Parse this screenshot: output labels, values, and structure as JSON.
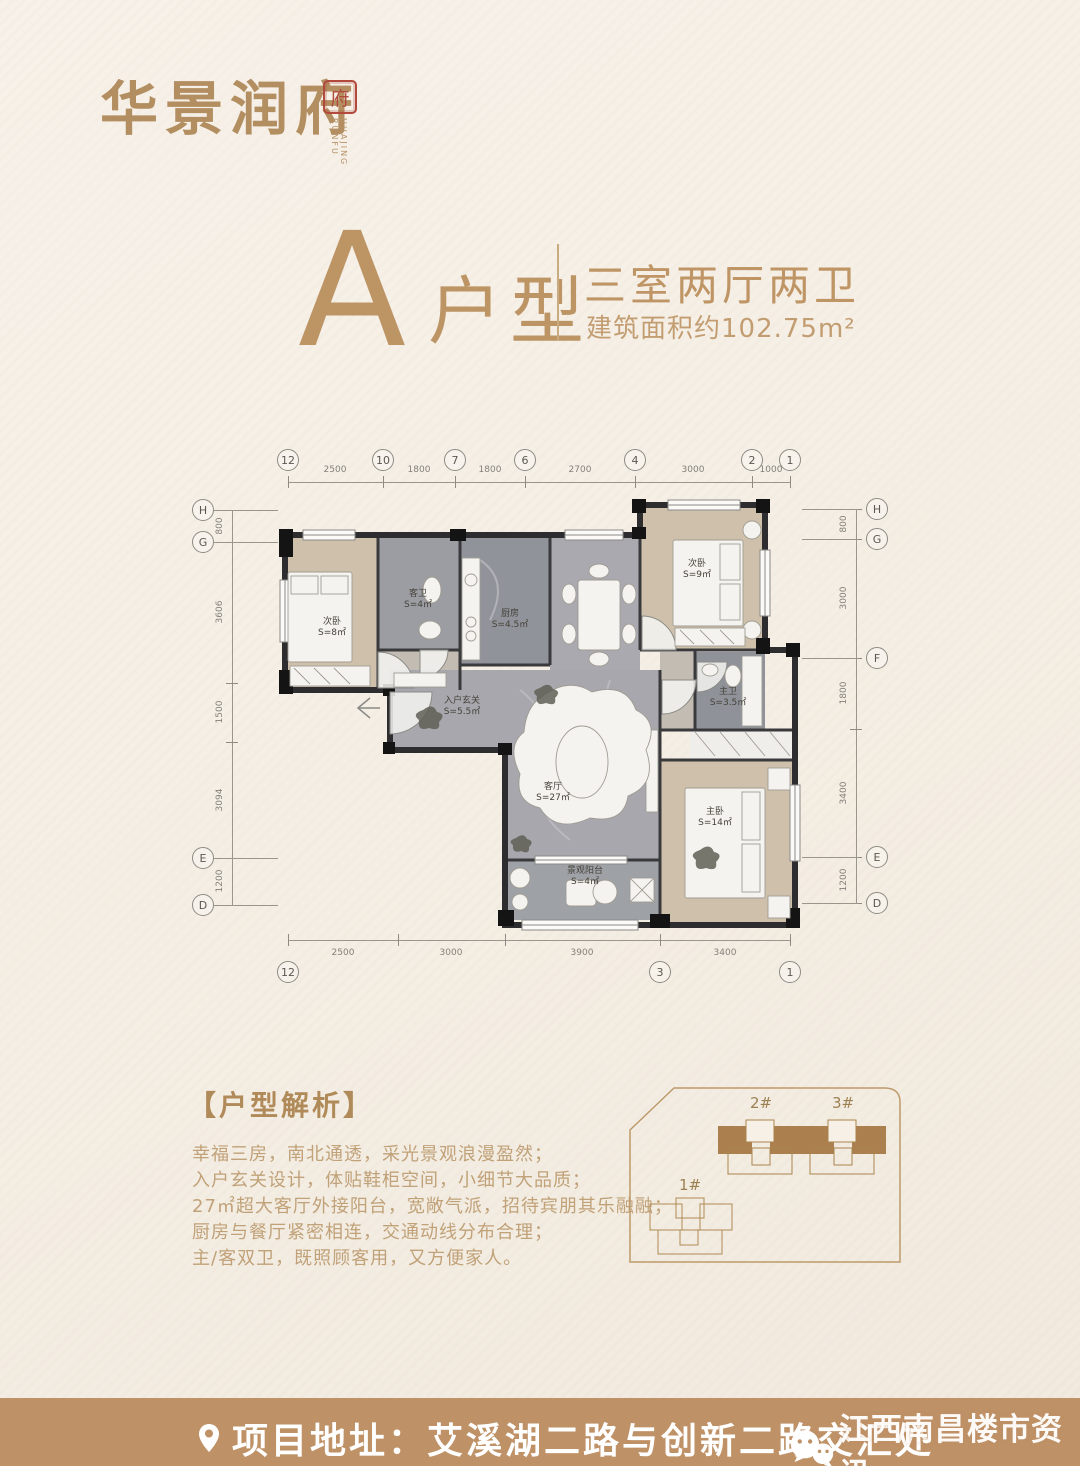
{
  "colors": {
    "accent_gold": "#bd9565",
    "seal_red": "#b14a3c",
    "footer_bar": "#bf9166",
    "site_brown": "#ab7f4e",
    "bg": "#f4eee4"
  },
  "logo": {
    "text": "华景润府",
    "seal_char": "府",
    "seal_caption": "HUAJING RUNFU"
  },
  "title": {
    "letter": "A",
    "type_label": "户型",
    "spec": "三室两厅两卫",
    "area": "建筑面积约102.75m²"
  },
  "floorplan": {
    "axis_top": {
      "labels": [
        "12",
        "10",
        "7",
        "6",
        "4",
        "2",
        "1"
      ],
      "dims": [
        "2500",
        "1800",
        "1800",
        "2700",
        "3000",
        "1000"
      ]
    },
    "axis_bottom": {
      "labels": [
        "12",
        "3",
        "1"
      ],
      "dims": [
        "2500",
        "3000",
        "3900",
        "3400"
      ]
    },
    "axis_left": {
      "labels": [
        "H",
        "G",
        "E",
        "D"
      ],
      "dims": [
        "800",
        "3606",
        "1500",
        "3094",
        "1200"
      ]
    },
    "axis_right": {
      "labels": [
        "H",
        "G",
        "F",
        "E",
        "D"
      ],
      "dims": [
        "800",
        "3000",
        "1800",
        "3400",
        "1200"
      ]
    },
    "rooms": [
      {
        "name": "次卧",
        "area": "S=8㎡"
      },
      {
        "name": "客卫",
        "area": "S=4㎡"
      },
      {
        "name": "厨房",
        "area": "S=4.5㎡"
      },
      {
        "name": "次卧",
        "area": "S=9㎡"
      },
      {
        "name": "主卫",
        "area": "S=3.5㎡"
      },
      {
        "name": "入户玄关",
        "area": "S=5.5㎡"
      },
      {
        "name": "客厅",
        "area": "S=27㎡"
      },
      {
        "name": "主卧",
        "area": "S=14㎡"
      },
      {
        "name": "景观阳台",
        "area": "S=4㎡"
      }
    ]
  },
  "analysis": {
    "heading": "【户型解析】",
    "lines": [
      "幸福三房，南北通透，采光景观浪漫盈然；",
      "入户玄关设计，体贴鞋柜空间，小细节大品质；",
      "27㎡超大客厅外接阳台，宽敞气派，招待宾朋其乐融融；",
      "厨房与餐厅紧密相连，交通动线分布合理；",
      "主/客双卫，既照顾客用，又方便家人。"
    ]
  },
  "siteplan": {
    "building2": "2#",
    "building3": "3#",
    "building1": "1#"
  },
  "footer": {
    "address": "项目地址：艾溪湖二路与创新二路交汇处",
    "watermark": "江西南昌楼市资讯"
  }
}
